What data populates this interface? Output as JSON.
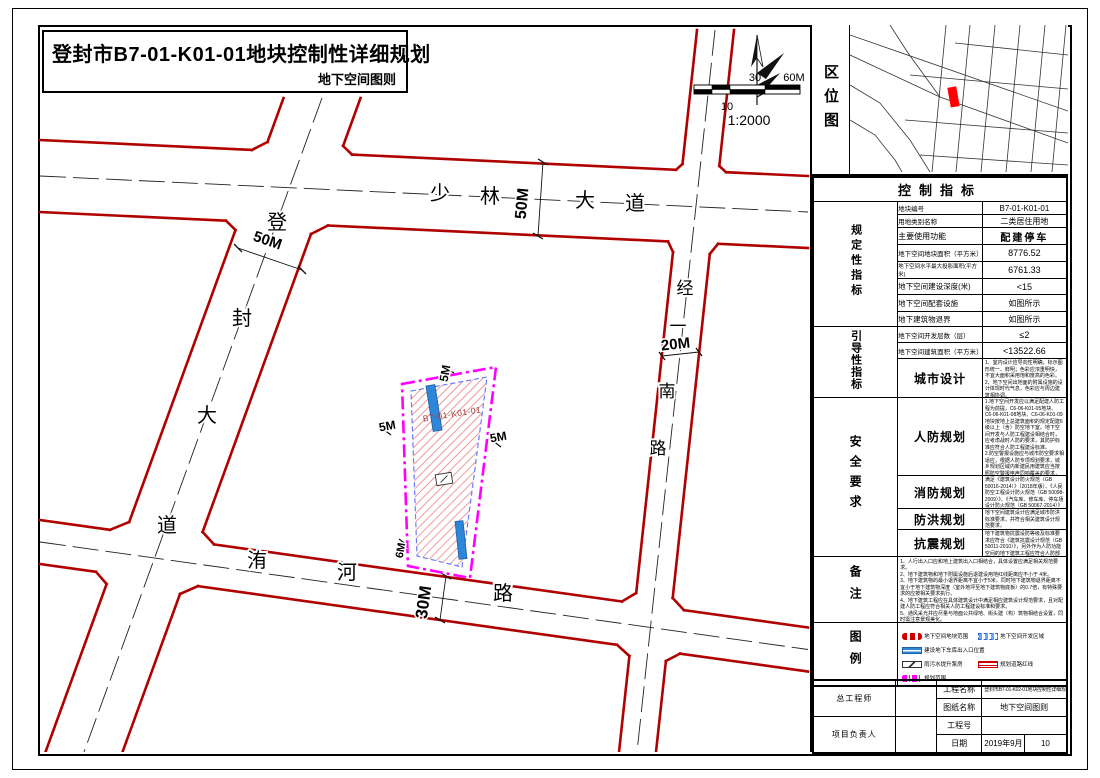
{
  "title": {
    "main": "登封市B7-01-K01-01地块控制性详细规划",
    "sub": "地下空间图则"
  },
  "colors": {
    "road_red": "#b00000",
    "parcel_magenta": "#ff00ff",
    "hatch_red": "#e87070",
    "access_blue": "#2e86d8",
    "location_marker_red": "#ff0000"
  },
  "location_map": {
    "label": "区位图"
  },
  "map": {
    "roads": {
      "shaolin": {
        "name": "少林大道",
        "chars": [
          "少",
          "林",
          "大",
          "道"
        ],
        "width": "50M"
      },
      "dengfeng": {
        "name": "登封大道",
        "chars": [
          "登",
          "封",
          "大",
          "道"
        ],
        "width": "50M"
      },
      "jingyi": {
        "name": "经一南路",
        "chars": [
          "经",
          "一",
          "南",
          "路"
        ],
        "width": "20M"
      },
      "weihe": {
        "name": "洧河路",
        "chars": [
          "洧",
          "河",
          "路"
        ],
        "width": "30M"
      }
    },
    "parcel": {
      "label": "B7-01-K01-01",
      "setback_top": "5M",
      "setback_left": "5M",
      "setback_right": "5M",
      "setback_bottom": "6M"
    },
    "scale": {
      "mid": "30",
      "end": "60M",
      "sub": "10",
      "ratio": "1:2000"
    }
  },
  "indicators": {
    "title": "控制指标",
    "group_regulatory": "规定性指标",
    "group_guiding": "引导性指标",
    "group_safety": "安全要求",
    "rows": {
      "parcel_no": {
        "label": "地块编号",
        "value": "B7-01-K01-01"
      },
      "land_class": {
        "label": "用地类别名称",
        "value": "二类居住用地"
      },
      "main_use": {
        "label": "主要使用功能",
        "value": "配建停车"
      },
      "site_area": {
        "label": "地下空间地块面积（平方米）",
        "value": "8776.52"
      },
      "max_proj_area": {
        "label": "地下空间水平最大投影面积(平方米)",
        "value": "6761.33"
      },
      "depth": {
        "label": "地下空间建设深度(米)",
        "value": "<15"
      },
      "facilities": {
        "label": "地下空间配套设施",
        "value": "如图所示"
      },
      "setback": {
        "label": "地下建筑物退界",
        "value": "如图所示"
      },
      "layers": {
        "label": "地下空间开发层数（层）",
        "value": "≤2"
      },
      "floor_area": {
        "label": "地下空间建筑面积（平方米）",
        "value": "<13522.66"
      },
      "urban_design": {
        "label": "城市设计",
        "value": "1、室内设计应导向性明确，标示图形统一、鲜明；色彩应浓重明快，不宜大面积采用饱和度高的色彩。\n2、地下空间出地面的附属设施的设计体现时代气息，色彩应与周边建筑相协调。"
      },
      "civil_defense": {
        "label": "人防规划",
        "value": "1.地下空间开发应以满足配建人防工程为前提，C6-06-K01-05地块、C6-06-K01-08地块、C6-06-K01-09地块按地上总建筑面积的规定配建6级以上（含）防空地下室。地下空间开发与人防工程建设相结合时，应考虑战时人防的要求，其防护标准应符合人防工程建设标准。\n2.防空警报设施应与城市防空要求相适应，根据人防专项规划要求，城乡规划区域内新建民用建筑应当按照防空警报电声同响覆盖的要求，安装防空警报设施。\n3.人防功能空间的建筑设计应满足《人民防空地下室设计规范（GB 50038-2005）》、《人民防空工程设计防火规范（GB 50098-2009）》和《城市居住区人民防空工程规划规范（GB 50808-2013）》的要求。"
      },
      "fire": {
        "label": "消防规划",
        "value": "满足《建筑设计防火规范（GB 50016-2014）》（2018年版）、《人民防空工程设计防火规范（GB 50098-2009）》、《汽车库、修车库、停车场设计防火规范（GB 50067-2014）》及其它相关规范的要求。"
      },
      "flood": {
        "label": "防洪规划",
        "value": "地下空间建筑设计应满足城市防洪标准要求，并符合相关建筑设计规范要求。"
      },
      "seismic": {
        "label": "抗震规划",
        "value": "地下建筑物抗震设防等级及标准要求应符合《建筑抗震设计规范（GB 50011-2010）》，另外作为人防功能空间的地下建筑工程应符合人防部门的相关要求规定。"
      }
    },
    "notes": {
      "label": "备注",
      "value": "1、人行出入口应和地上建筑出入口相结合，具体设置应满足相关规范要求。\n2、地下建筑物和地下附属设施后退建设用地红线距离应不小于 4米。\n3、地下建筑物的最小退界距离不宜小于5米，同时地下建筑物退界距离不宜小于地下建筑物深度（室外地坪至地下建筑物底板）的0.7倍，有特殊要求的应按相关要求执行。\n4、地下建筑工程应在具体建筑设计中满足相应建筑设计规范要求，且对配建人防工程应符合相关人防工程建设标准和要求。\n5、通风采光井应尽量与地面公共绿地、街头建（构）筑物相结合设置，同时需注意景观美化。"
    },
    "legend": {
      "label": "图例",
      "items": [
        {
          "label": "地下空间地块范围"
        },
        {
          "label": "地下空间开发区域"
        },
        {
          "label": "建设地下车库出入口位置"
        },
        {
          "label": "雨污水提升泵房"
        },
        {
          "label": "规划道路红线"
        },
        {
          "label": "规划范围"
        }
      ]
    }
  },
  "titleblock": {
    "chief_engineer": "总工程师",
    "project_director": "项目负责人",
    "project_name_label": "工程名称",
    "project_name": "登封市B7-01-K02-01地块控制性详细规划",
    "drawing_name_label": "图纸名称",
    "drawing_name": "地下空间图则",
    "project_no_label": "工程号",
    "date_label": "日期",
    "date": "2019年9月",
    "sheet_no": "10"
  }
}
